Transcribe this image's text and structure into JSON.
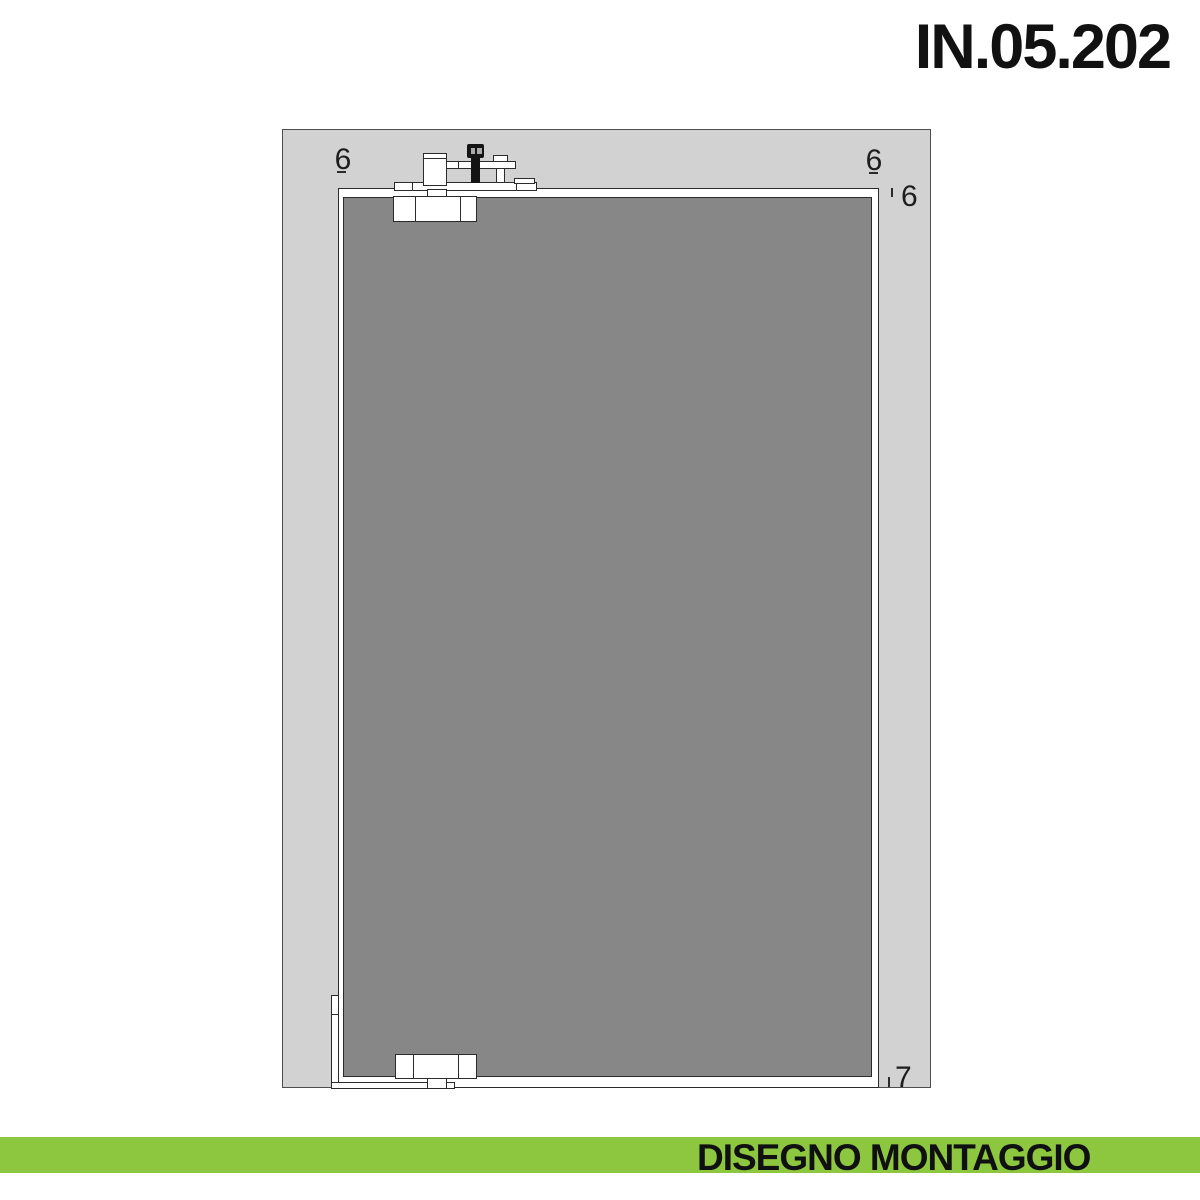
{
  "title": "IN.05.202",
  "footer": {
    "label": "DISEGNO MONTAGGIO"
  },
  "colors": {
    "accent_green": "#8dc63f",
    "wall_gray": "#d2d2d2",
    "glass_gray": "#878787",
    "line": "#2b2b2b",
    "title_black": "#111111"
  },
  "drawing": {
    "section_labels": {
      "top_left": "6",
      "top_right": "6",
      "right_top": "6",
      "right_bottom": "7"
    }
  }
}
